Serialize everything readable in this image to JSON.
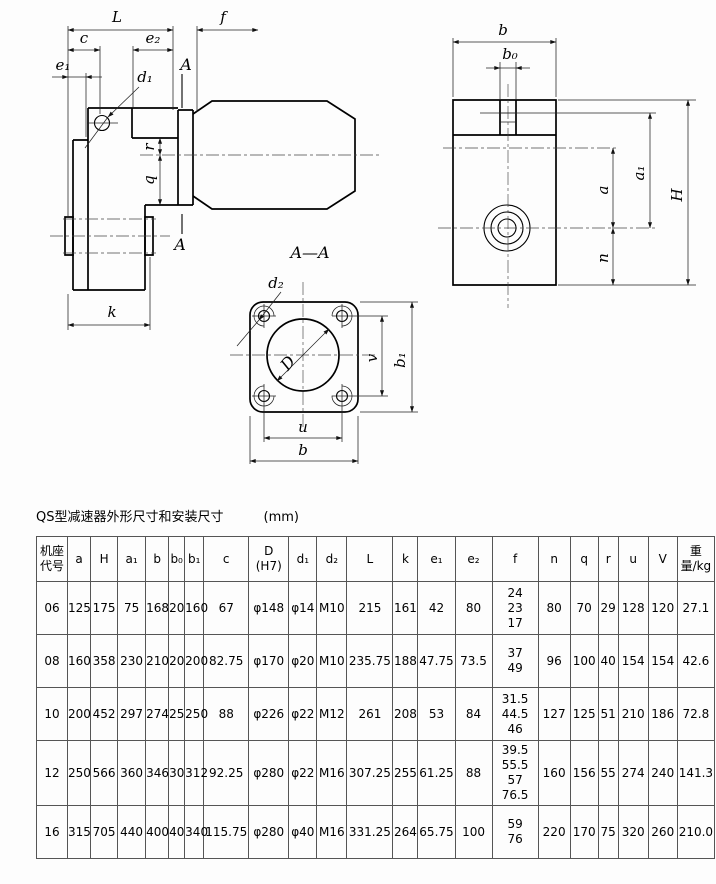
{
  "drawing": {
    "front_view_labels": {
      "L": "L",
      "f": "f",
      "c": "c",
      "e2": "e₂",
      "e1": "e₁",
      "d1": "d₁",
      "A_top": "A",
      "A_bottom": "A",
      "r": "r",
      "q": "q",
      "k": "k"
    },
    "side_view_labels": {
      "b": "b",
      "b0": "b₀",
      "a": "a",
      "a1": "a₁",
      "H": "H",
      "n": "n"
    },
    "section_view": {
      "title": "A—A",
      "labels": {
        "d2": "d₂",
        "D": "D",
        "v": "v",
        "b1": "b₁",
        "u": "u",
        "b": "b"
      }
    }
  },
  "table": {
    "title": "QS型减速器外形尺寸和安装尺寸",
    "unit": "(mm)",
    "headers": [
      [
        "机座",
        "代号"
      ],
      "a",
      "H",
      "a₁",
      "b",
      "b₀",
      "b₁",
      "c",
      [
        "D",
        "(H7)"
      ],
      "d₁",
      "d₂",
      "L",
      "k",
      "e₁",
      "e₂",
      "f",
      "n",
      "q",
      "r",
      "u",
      "V",
      [
        "重",
        "量/kg"
      ]
    ],
    "col_widths": [
      31,
      23,
      27,
      28,
      23,
      16,
      19,
      45,
      40,
      28,
      30,
      46,
      25,
      37,
      37,
      46,
      32,
      28,
      20,
      30,
      29,
      37
    ],
    "rows": [
      [
        "06",
        "125",
        "175",
        "75",
        "168",
        "20",
        "160",
        "67",
        "φ148",
        "φ14",
        "M10",
        "215",
        "161",
        "42",
        "80",
        [
          "24",
          "23",
          "17"
        ],
        "80",
        "70",
        "29",
        "128",
        "120",
        "27.1"
      ],
      [
        "08",
        "160",
        "358",
        "230",
        "210",
        "20",
        "200",
        "82.75",
        "φ170",
        "φ20",
        "M10",
        "235.75",
        "188",
        "47.75",
        "73.5",
        [
          "37",
          "49"
        ],
        "96",
        "100",
        "40",
        "154",
        "154",
        "42.6"
      ],
      [
        "10",
        "200",
        "452",
        "297",
        "274",
        "25",
        "250",
        "88",
        "φ226",
        "φ22",
        "M12",
        "261",
        "208",
        "53",
        "84",
        [
          "31.5",
          "44.5",
          "46"
        ],
        "127",
        "125",
        "51",
        "210",
        "186",
        "72.8"
      ],
      [
        "12",
        "250",
        "566",
        "360",
        "346",
        "30",
        "312",
        "92.25",
        "φ280",
        "φ22",
        "M16",
        "307.25",
        "255",
        "61.25",
        "88",
        [
          "39.5",
          "55.5",
          "57",
          "76.5"
        ],
        "160",
        "156",
        "55",
        "274",
        "240",
        "141.3"
      ],
      [
        "16",
        "315",
        "705",
        "440",
        "400",
        "40",
        "340",
        "115.75",
        "φ280",
        "φ40",
        "M16",
        "331.25",
        "264",
        "65.75",
        "100",
        [
          "59",
          "76"
        ],
        "220",
        "170",
        "75",
        "320",
        "260",
        "210.0"
      ]
    ]
  }
}
